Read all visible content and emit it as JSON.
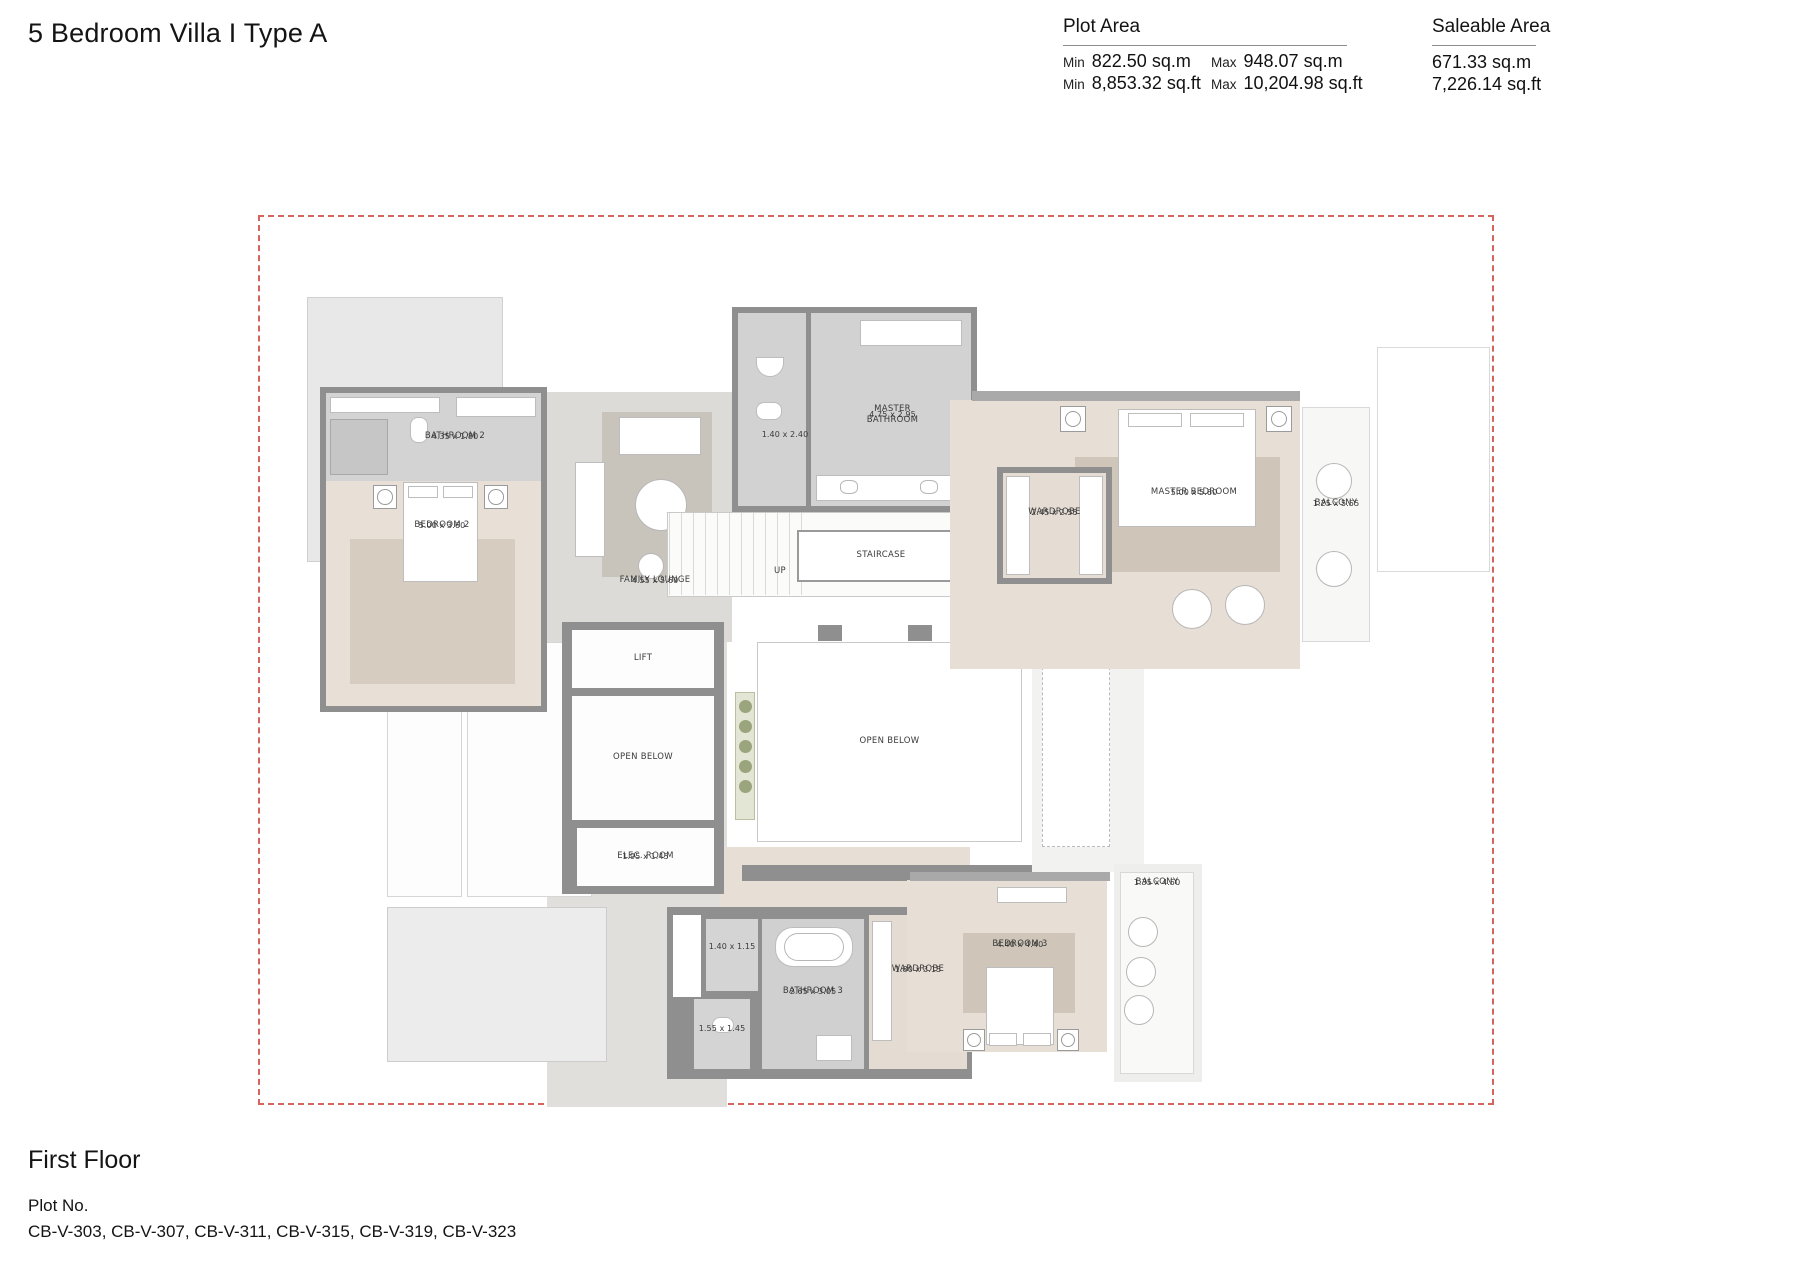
{
  "page": {
    "title": "5 Bedroom Villa I Type A"
  },
  "plot_area": {
    "heading": "Plot Area",
    "rows": [
      {
        "min_label": "Min",
        "min_value": "822.50 sq.m",
        "max_label": "Max",
        "max_value": "948.07 sq.m"
      },
      {
        "min_label": "Min",
        "min_value": "8,853.32 sq.ft",
        "max_label": "Max",
        "max_value": "10,204.98 sq.ft"
      }
    ]
  },
  "saleable_area": {
    "heading": "Saleable Area",
    "values": [
      "671.33 sq.m",
      "7,226.14 sq.ft"
    ]
  },
  "footer": {
    "floor_label": "First Floor",
    "plot_no_label": "Plot No.",
    "plot_numbers": "CB-V-303, CB-V-307, CB-V-311, CB-V-315, CB-V-319, CB-V-323"
  },
  "plan": {
    "boundary_color": "#d4645e",
    "wall_color": "#8f8f8f",
    "floor_beige": "#e7ded5",
    "floor_gray": "#d2d2d2",
    "carpet_gray": "#c9c5bc",
    "rooms": [
      {
        "name": "BATHROOM 2",
        "dims": "4.35 x 1.80"
      },
      {
        "name": "BEDROOM 2",
        "dims": "5.00 x 3.60"
      },
      {
        "name": "FAMILY LOUNGE",
        "dims": "4.55 x 5.60"
      },
      {
        "dims": "1.40 x 2.40"
      },
      {
        "name": "MASTER BATHROOM",
        "dims": "4.75 x 2.95"
      },
      {
        "name": "STAIRCASE"
      },
      {
        "name": "UP"
      },
      {
        "name": "WARDROBE",
        "dims": "2.45 x 2.55"
      },
      {
        "name": "MASTER BEDROOM",
        "dims": "5.00 x 5.60"
      },
      {
        "name": "BALCONY",
        "dims": "1.25 x 5.55"
      },
      {
        "name": "LIFT"
      },
      {
        "name": "OPEN BELOW"
      },
      {
        "name": "ELEC. ROOM",
        "dims": "1.95 x 1.45"
      },
      {
        "name": "OPEN BELOW"
      },
      {
        "dims": "1.40 x 1.15"
      },
      {
        "dims": "1.55 x 1.45"
      },
      {
        "name": "BATHROOM 3",
        "dims": "2.65 x 3.05"
      },
      {
        "name": "WARDROBE",
        "dims": "1.80 x 3.15"
      },
      {
        "name": "BEDROOM 3",
        "dims": "4.40 x 4.40"
      },
      {
        "name": "BALCONY",
        "dims": "1.35 x 4.50"
      }
    ]
  }
}
